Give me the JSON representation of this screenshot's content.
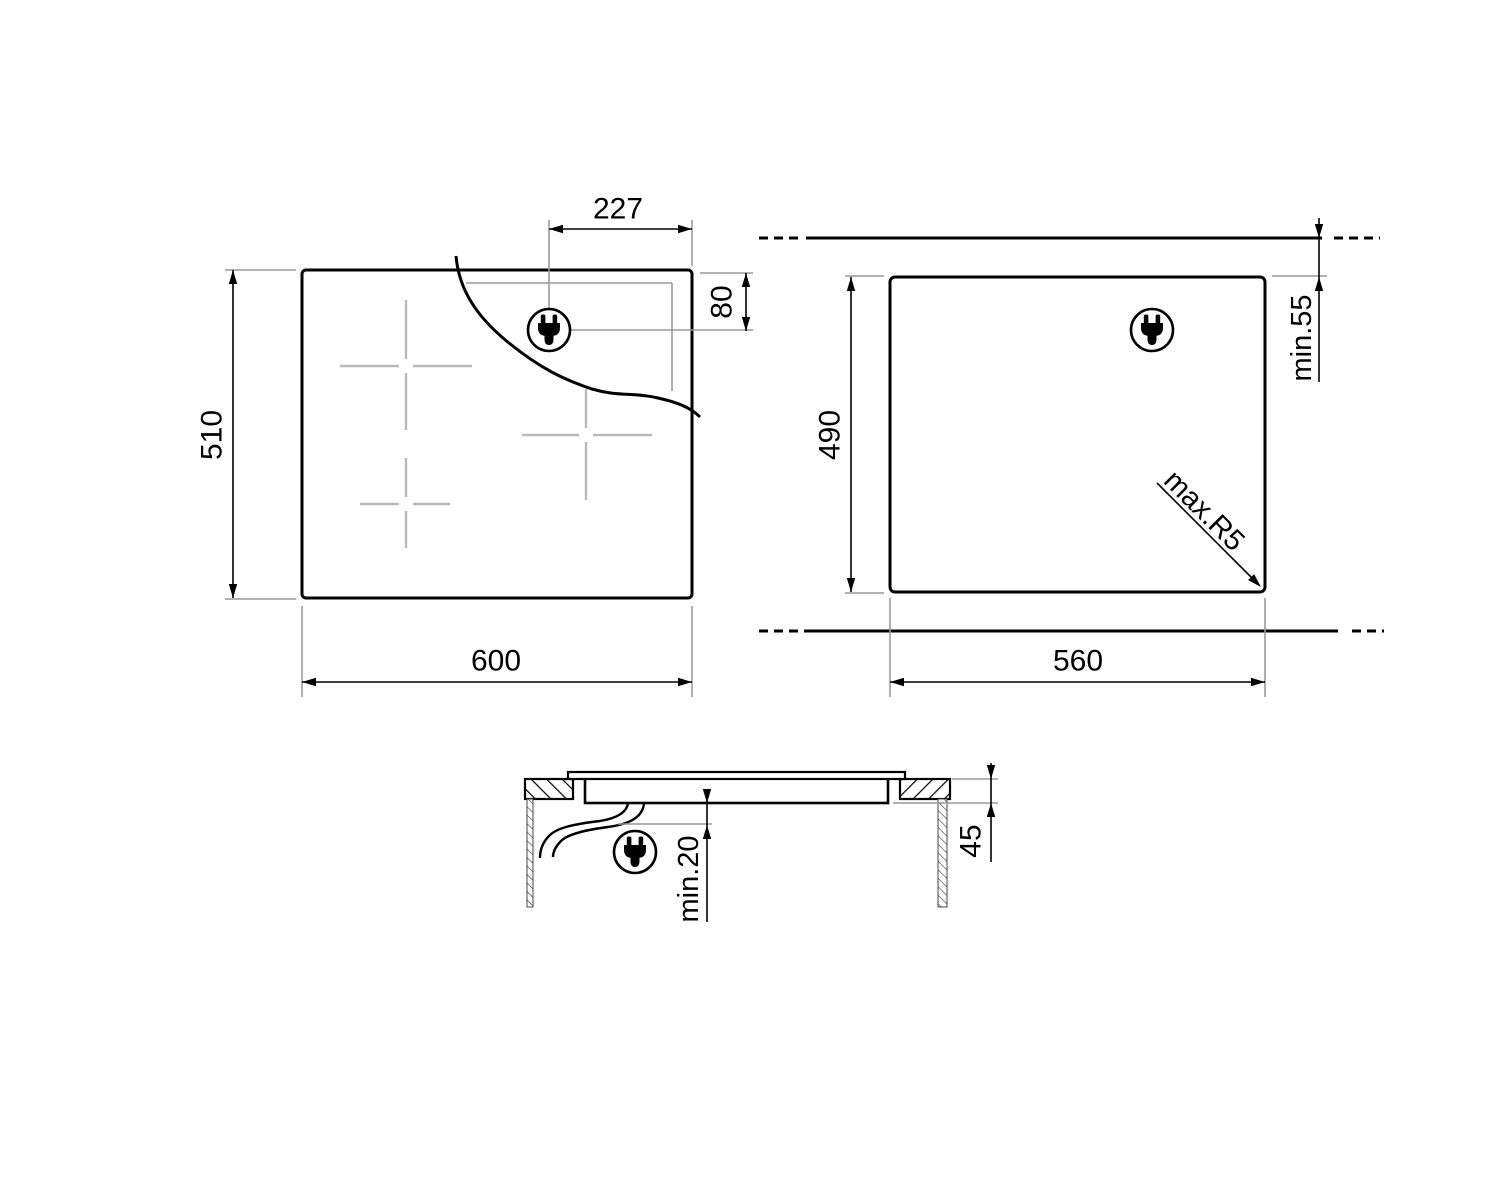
{
  "diagram": {
    "kind": "hob-installation-dimension-drawing",
    "labels": {
      "top_view": {
        "width": "600",
        "height": "510",
        "plug_offset_x": "227",
        "plug_offset_y": "80"
      },
      "cutout_view": {
        "width": "560",
        "height": "490",
        "wall_clearance": "min.55",
        "corner_radius": "max.R5"
      },
      "section_view": {
        "built_in_depth": "45",
        "clearance_below": "min.20"
      }
    },
    "icons": {
      "power_plug": "plug-in-circle"
    },
    "colors": {
      "line": "#000000",
      "extension_line": "#999999",
      "zone_cross": "#b8b8b8",
      "background": "#ffffff"
    }
  }
}
